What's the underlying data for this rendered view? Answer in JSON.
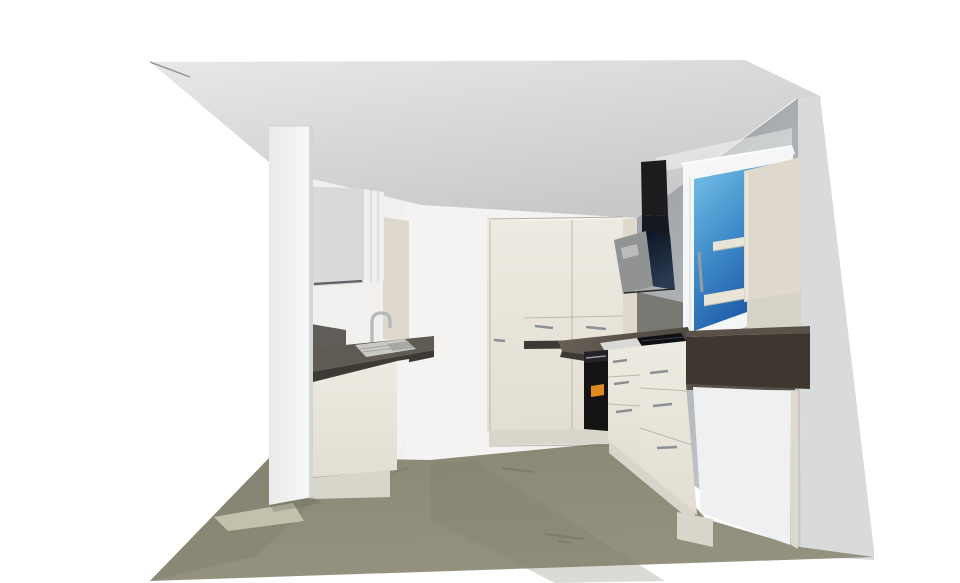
{
  "scene": {
    "type": "kitchen-3d-render",
    "view": "interior-perspective"
  },
  "objects": {
    "room": "kitchen",
    "left_run": [
      "wall-cabinet",
      "sink",
      "faucet",
      "countertop",
      "sink-base-cabinet",
      "dishwasher-front"
    ],
    "back_run": [
      "tall-pantry-cabinet",
      "tall-cabinet-block",
      "drawer-fronts",
      "counter-strip"
    ],
    "right_run": [
      "built-in-oven",
      "cooktop",
      "drawer-stacks",
      "counter-end-panel",
      "appliance-end-panel"
    ],
    "fixtures": [
      "extractor-hood",
      "window",
      "wall-shelf-unit",
      "partition-column"
    ]
  },
  "colors": {
    "bg": "#ffffff",
    "ceiling_light": "#e8e8e8",
    "ceiling_dark": "#c7c8c9",
    "left_wall": "#f1f0ee",
    "back_wall": "#f4f3f1",
    "right_wall_top": "#989a9d",
    "right_wall_bottom": "#c7cacc",
    "right_wall_outer": "#d8dadc",
    "partition_main": "#eaeaeb",
    "partition_light": "#f8f8f9",
    "partition_edge": "#d3d4d6",
    "floor_main": "#94927f",
    "floor_back": "#898875",
    "floor_dark": "#7e7d6b",
    "floor_patch": "#cac6b2",
    "floor_shadow": "#6f6e5f",
    "cabinet_front_top": "#edeae1",
    "cabinet_front_bottom": "#e2ded2",
    "cabinet_front_dark": "#ded9cc",
    "cabinet_side": "#f2f3f4",
    "cabinet_plinth": "#d8d5cb",
    "cabinet_line": "#bcb8ab",
    "upper_gray": "#d7d9da",
    "upper_gray_light": "#edeff0",
    "counter_top": "#5f5a52",
    "counter_edge": "#3d3934",
    "counter_right_1": "#6b6359",
    "counter_right_2": "#4a443d",
    "counter_box_front": "#3e3730",
    "counter_box_top": "#5a5248",
    "backsplash_left": "#605d58",
    "backsplash_right": "#7a7873",
    "backsplash_window": "#575149",
    "sink_steel": "#c8c8c5",
    "sink_basin": "#a9a9a6",
    "faucet": "#b4b8bb",
    "oven_body": "#131313",
    "oven_panel": "#232327",
    "oven_display": "#e0891d",
    "handle": "#8b9094",
    "cooktop": "#0f1014",
    "cooktop_rim": "#d9d9d6",
    "hood_chimney": "#1c1c1f",
    "hood_glass_a": "#0c1422",
    "hood_glass_b": "#2a3b52",
    "hood_panel": "#909294",
    "hood_inset": "#b9bbbc",
    "window_frame": "#f4f6f7",
    "glass_a": "#79c3ea",
    "glass_b": "#3f8cc9",
    "glass_c": "#1b54a4",
    "window_handle": "#979da2",
    "window_light": "#fdfeff",
    "shelf_panel": "#ded9cc",
    "shelf_board": "#e8e4d8",
    "shelf_under": "#d6d2c5",
    "end_panel": "#eef0f2"
  }
}
